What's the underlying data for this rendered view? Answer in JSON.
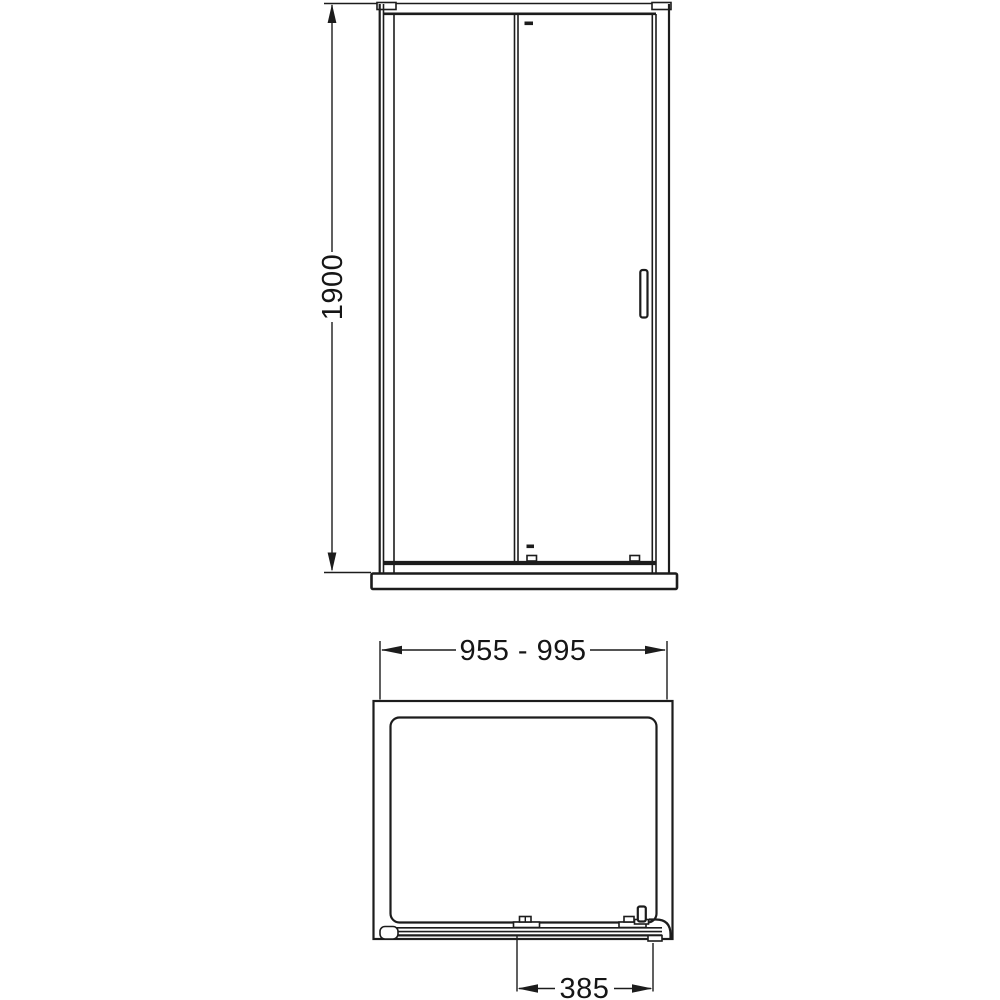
{
  "page": {
    "background_color": "#ffffff",
    "line_color": "#1c1c1c"
  },
  "front_elevation": {
    "height_dimension_label": "1900"
  },
  "plan_view": {
    "width_dimension_label": "955 - 995",
    "door_opening_dimension_label": "385"
  }
}
